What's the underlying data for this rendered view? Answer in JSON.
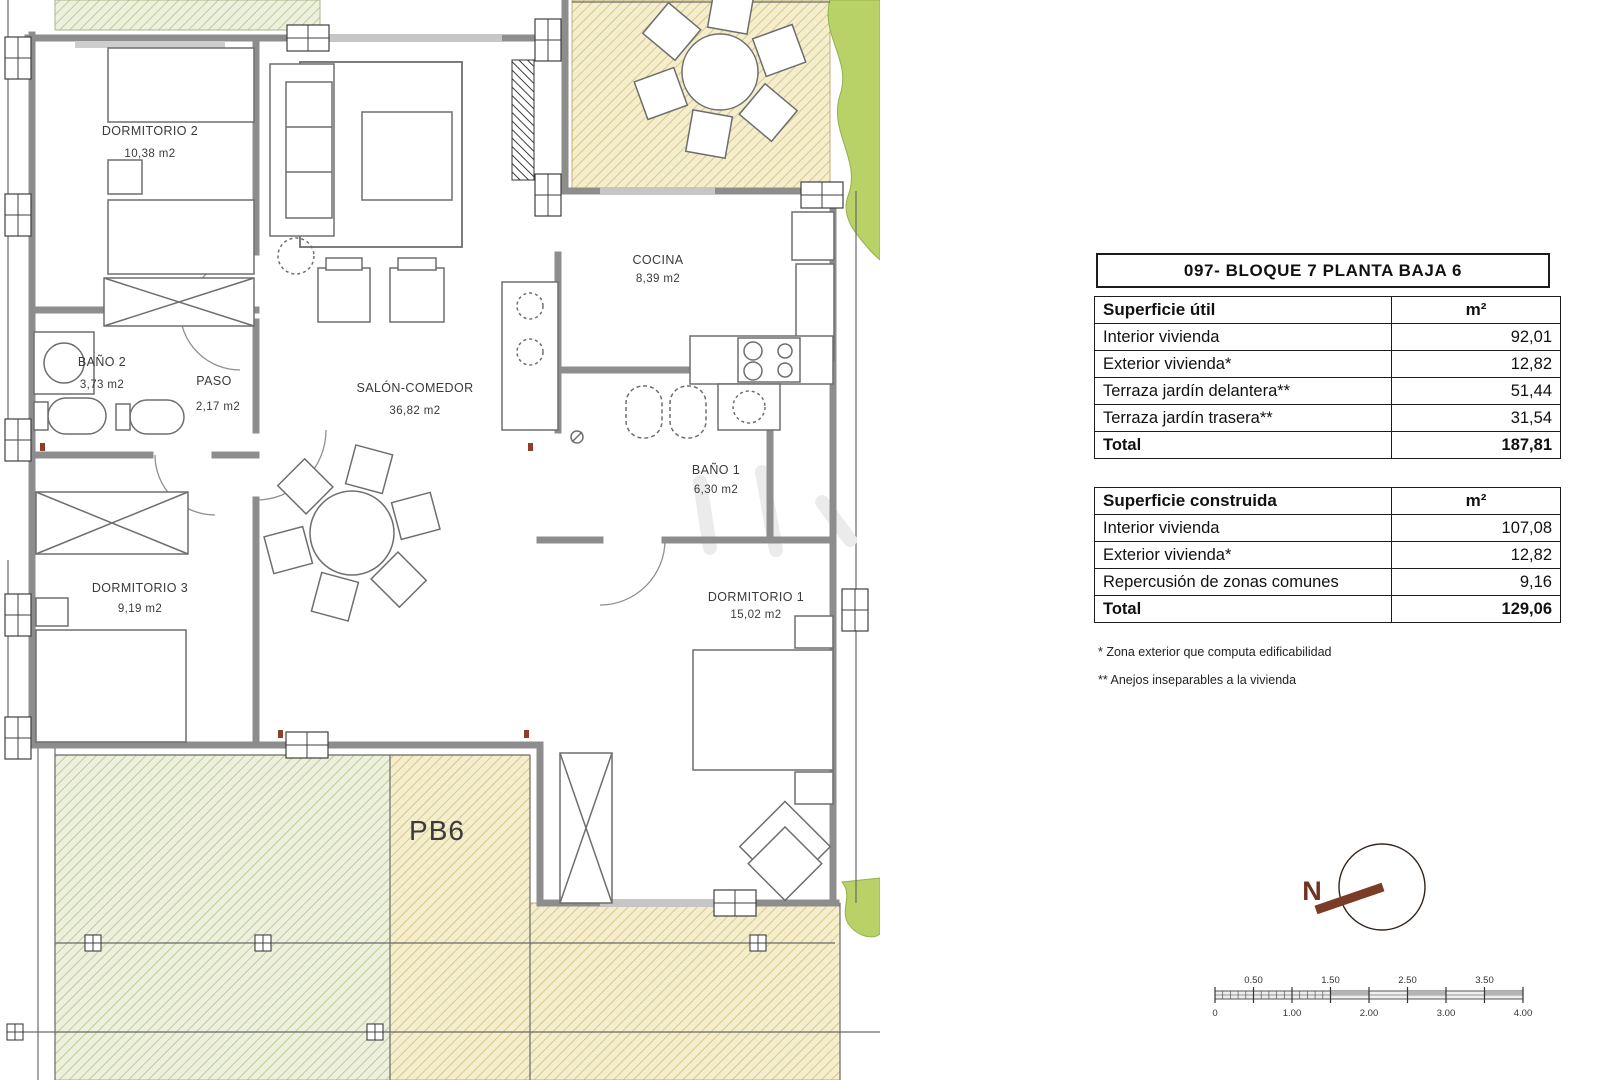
{
  "document": {
    "title": "097- BLOQUE 7 PLANTA BAJA 6"
  },
  "tables": {
    "util": {
      "header": "Superficie útil",
      "unit": "m²",
      "rows": [
        {
          "label": "Interior vivienda",
          "value": "92,01"
        },
        {
          "label": "Exterior vivienda*",
          "value": "12,82"
        },
        {
          "label": "Terraza jardín delantera**",
          "value": "51,44"
        },
        {
          "label": "Terraza jardín trasera**",
          "value": "31,54"
        }
      ],
      "total_label": "Total",
      "total_value": "187,81"
    },
    "construida": {
      "header": "Superficie construida",
      "unit": "m²",
      "rows": [
        {
          "label": "Interior vivienda",
          "value": "107,08"
        },
        {
          "label": "Exterior vivienda*",
          "value": "12,82"
        },
        {
          "label": "Repercusión de zonas comunes",
          "value": "9,16"
        }
      ],
      "total_label": "Total",
      "total_value": "129,06"
    }
  },
  "footnotes": [
    "* Zona exterior que computa edificabilidad",
    "** Anejos inseparables a la vivienda"
  ],
  "plan": {
    "unit_label": "PB6",
    "rooms": [
      {
        "name": "DORMITORIO 2",
        "area": "10,38 m2"
      },
      {
        "name": "BAÑO 2",
        "area": "3,73 m2"
      },
      {
        "name": "PASO",
        "area": "2,17 m2"
      },
      {
        "name": "SALÓN-COMEDOR",
        "area": "36,82 m2"
      },
      {
        "name": "COCINA",
        "area": "8,39 m2"
      },
      {
        "name": "BAÑO 1",
        "area": "6,30 m2"
      },
      {
        "name": "DORMITORIO 3",
        "area": "9,19 m2"
      },
      {
        "name": "DORMITORIO 1",
        "area": "15,02 m2"
      }
    ]
  },
  "compass": {
    "north_label": "N"
  },
  "scalebar": {
    "top_labels": [
      "0.50",
      "1.50",
      "2.50",
      "3.50"
    ],
    "bottom_labels": [
      "0",
      "1.00",
      "2.00",
      "3.00",
      "4.00"
    ]
  },
  "colors": {
    "wall_gray": "#8d8d8d",
    "hatch_green_bg": "#ecf0dd",
    "hatch_green_line": "#b4c489",
    "hatch_yellow_bg": "#f4eecd",
    "hatch_yellow_line": "#cfbe7d",
    "vegetation_green": "#b8d268",
    "compass_brown": "#7b3c26",
    "table_border": "#1c1c1c"
  }
}
